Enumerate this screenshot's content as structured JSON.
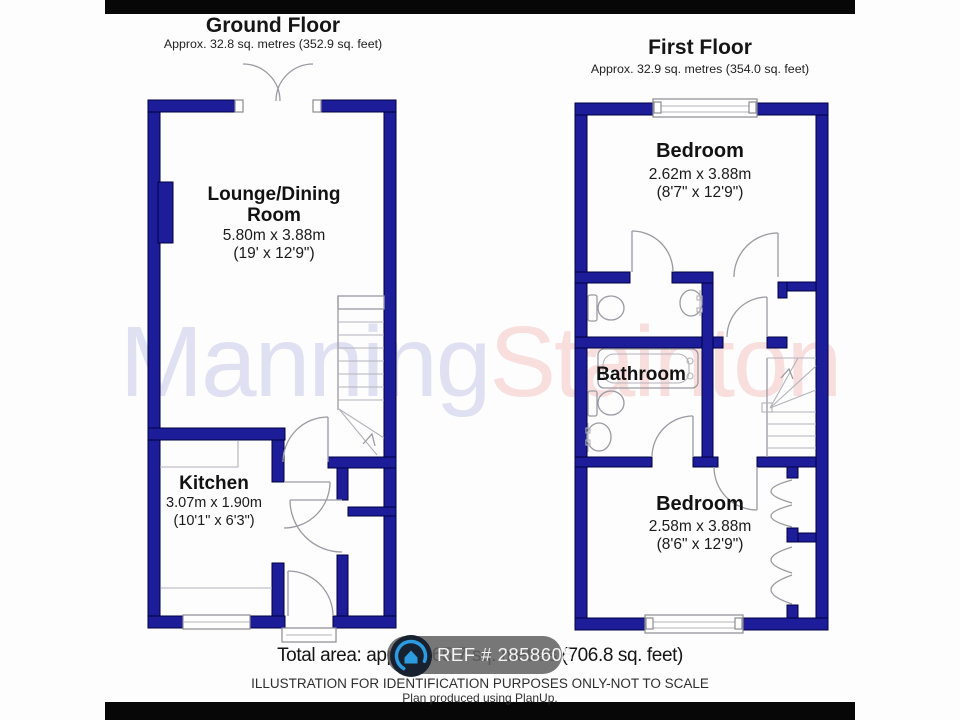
{
  "watermark": {
    "first": "Manning",
    "second": "Stainton"
  },
  "ground_floor": {
    "title": "Ground Floor",
    "subtitle": "Approx. 32.8 sq. metres (352.9 sq. feet)",
    "lounge": {
      "name1": "Lounge/Dining",
      "name2": "Room",
      "metric": "5.80m x 3.88m",
      "imperial": "(19' x 12'9\")"
    },
    "kitchen": {
      "name": "Kitchen",
      "metric": "3.07m x 1.90m",
      "imperial": "(10'1\" x 6'3\")"
    }
  },
  "first_floor": {
    "title": "First Floor",
    "subtitle": "Approx. 32.9 sq. metres (354.0 sq. feet)",
    "bedroom_front": {
      "name": "Bedroom",
      "metric": "2.62m x 3.88m",
      "imperial": "(8'7\" x 12'9\")"
    },
    "bathroom": {
      "name": "Bathroom"
    },
    "bedroom_back": {
      "name": "Bedroom",
      "metric": "2.58m x 3.88m",
      "imperial": "(8'6\" x 12'9\")"
    }
  },
  "footer": {
    "total_area": "Total area: approx. 65.7 sq. metres (706.8 sq. feet)",
    "ref_badge": "REF # 2858608",
    "disclaimer": "ILLUSTRATION FOR IDENTIFICATION PURPOSES ONLY-NOT TO SCALE",
    "produced_by": "Plan produced using PlanUp."
  },
  "colors": {
    "wall": "#1d1d99",
    "watermark_first": "#dfe1f3",
    "watermark_second": "#f8dedd",
    "badge_background": "#646464",
    "logo_blue": "#2d9be0"
  }
}
